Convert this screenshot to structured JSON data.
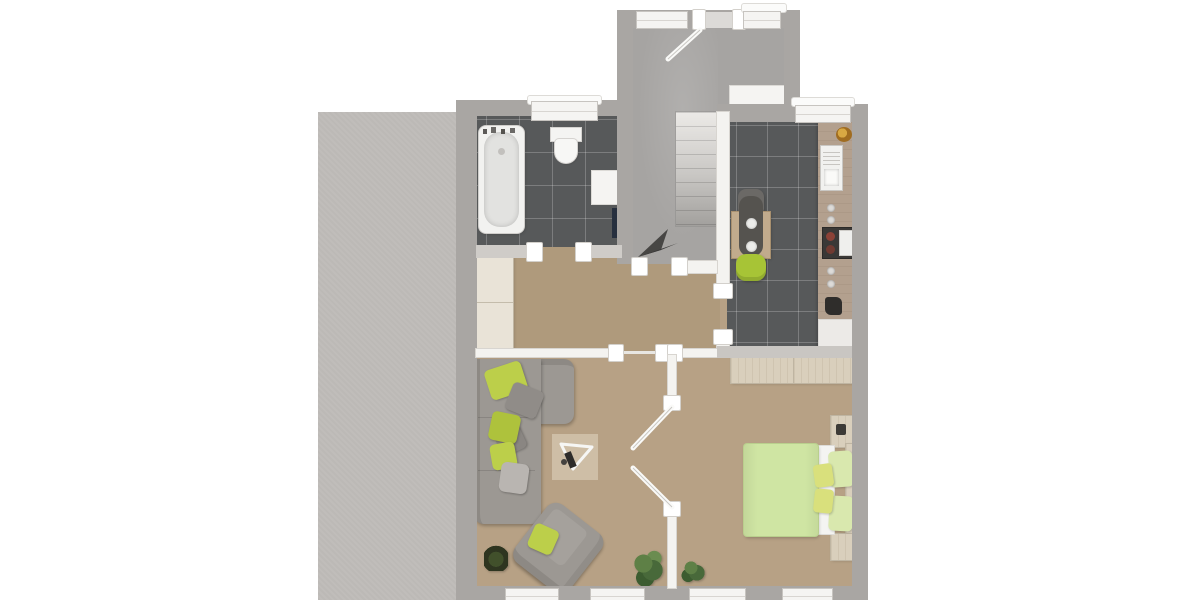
{
  "scene": {
    "kind": "3d-floor-plan-top-view",
    "description": "Rendered top-down 3D floor plan of an apartment with entry stairwell, bathroom, kitchen, hallway, living room and bedroom; a gray textured neighbouring building block sits on the left; no text labels are rendered",
    "has_text_labels": false
  },
  "palette": {
    "exterior_wall": "#a9a6a3",
    "interior_wall": "#f4f3f0",
    "neighbor_block": "#c0bdba",
    "entry_floor": "#a6a4a2",
    "wet_room_tile": "#57595a",
    "wood_floor": "#b7a185",
    "sofa_gray": "#9c9893",
    "accent_green": "#bccf4a",
    "bed_green": "#cfe5a3",
    "chair_green": "#a7c436",
    "wood_furniture": "#d9cfbc",
    "kitchen_counter": "#b3a08e",
    "appliance_dark": "#3a3836",
    "radiator_navy": "#27303f",
    "plant_green": "#48693a",
    "stair_arrow": "#474644"
  },
  "rooms": [
    {
      "id": "entry-stairwell",
      "floor": "gray screed",
      "features": [
        "entry-door with open leaf",
        "window left of door",
        "window right of door",
        "white built-in cabinet",
        "staircase of 8 treads",
        "direction-arrow"
      ]
    },
    {
      "id": "bathroom",
      "floor": "anthracite tiles",
      "furniture": [
        "bathtub with fittings",
        "toilet",
        "white cabinet",
        "navy radiator"
      ],
      "windows": 1,
      "doors": [
        "opening to hallway"
      ]
    },
    {
      "id": "kitchen",
      "floor": "anthracite tiles",
      "furniture": [
        "counter with sink, hob, oven and small appliances",
        "fruit bowl",
        "dining table with runner and two plates",
        "dark chair",
        "green chair",
        "potted plant"
      ],
      "windows": 1,
      "doors": [
        "opening to hallway"
      ]
    },
    {
      "id": "hallway",
      "floor": "beige",
      "furniture": [
        "wardrobe"
      ],
      "doors": [
        "opening to stairwell",
        "opening to living room",
        "opening to kitchen",
        "opening to bathroom"
      ]
    },
    {
      "id": "living-room",
      "floor": "beige",
      "furniture": [
        "gray corner sofa with green and gray pillows",
        "rotated armchair with green cushion",
        "triangular glass coffee table on light rug",
        "small potted plant",
        "tall potted plant"
      ],
      "windows": 2
    },
    {
      "id": "bedroom",
      "floor": "beige",
      "furniture": [
        "double bed with green duvet and pillows",
        "two travertine nightstands",
        "headboard",
        "sideboard under kitchen wall",
        "potted plant"
      ],
      "windows": 2,
      "doors": [
        "double doors to living room, both leaves open"
      ]
    }
  ],
  "exterior": {
    "neighbor_area": "large gray speckled block adjoining the left wall"
  }
}
